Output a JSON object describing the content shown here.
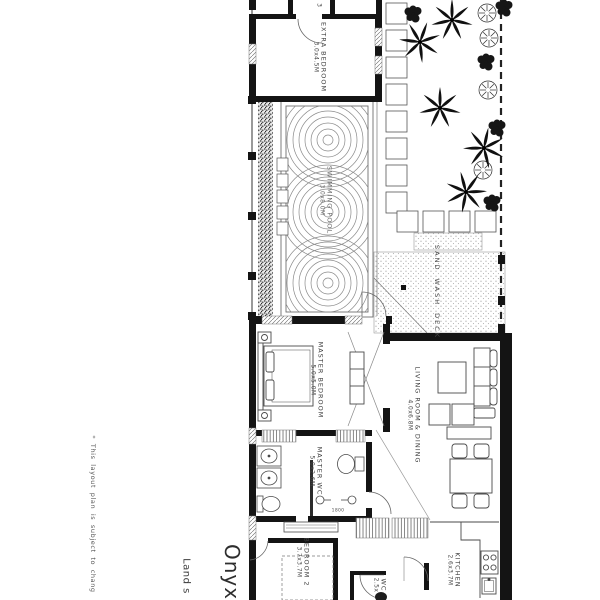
{
  "colors": {
    "background": "#ffffff",
    "wall": "#141414",
    "thin_line": "#4a4a4a",
    "texture_dot": "#8f8f8f",
    "label_text": "#3f3f3f"
  },
  "titles": {
    "project": "Onyx",
    "land": "Land s"
  },
  "disclaimer": {
    "bullet": "*",
    "text": "This layout plan is subject to chang"
  },
  "rooms": {
    "extra_bedroom": {
      "name": "EXTRA BEDROOM",
      "dim": "3.0x4.5M"
    },
    "swimming_pool": {
      "name": "SWIMMING POOL",
      "dim": "3.0x8.0M"
    },
    "sand_wash_deck": {
      "name": "SAND WASH DECK"
    },
    "master_bedroom": {
      "name": "MASTER BEDROOM",
      "dim": "5.0x5.0M"
    },
    "living_dining": {
      "name": "LIVING ROOM & DINING",
      "dim": "4.0x6.8M"
    },
    "master_wc": {
      "name": "MASTER WC",
      "dim": "5.0x2.6M"
    },
    "bedroom_2": {
      "name": "BEDROOM 2",
      "dim": "3.7x3.7M"
    },
    "wc": {
      "name": "WC",
      "dim": "2.5x"
    },
    "kitchen": {
      "name": "KITCHEN",
      "dim": "2.6x3.7M"
    }
  },
  "annotations": {
    "shower_width": "1800",
    "top_room_number": "3"
  }
}
